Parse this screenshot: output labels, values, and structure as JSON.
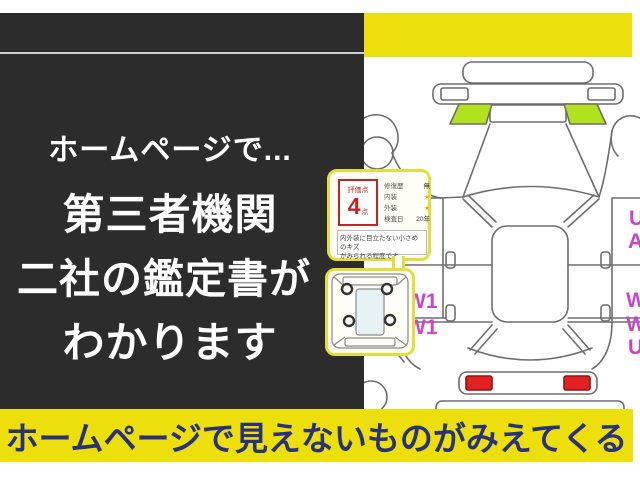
{
  "left_panel": {
    "lines": [
      "ホームページで...",
      "第三者機関",
      "二社の鑑定書が",
      "わかります"
    ]
  },
  "bottom_banner": {
    "text": "ホームページで見えないものがみえてくる"
  },
  "rating_card": {
    "score_label": "評価点",
    "score": "4",
    "score_unit": "点",
    "rows": [
      {
        "label": "修復歴",
        "value": "無"
      },
      {
        "label": "内装",
        "value": "★"
      },
      {
        "label": "外装",
        "value": "★"
      },
      {
        "label": "検査日",
        "value": "20年"
      }
    ],
    "note_line1": "内外装に目立たない小さめのキズ",
    "note_line2": "がみられる程度です。"
  },
  "diagram_marks": {
    "w1_left_top": "W1",
    "w1_left_bottom": "W1",
    "edge_u_top": "U",
    "edge_a": "A",
    "edge_w_top": "W",
    "edge_w_bottom": "W",
    "edge_u_bottom": "U"
  },
  "colors": {
    "frame_yellow": "#ecdf0c",
    "panel_dark": "#2d2c2c",
    "banner_text_navy": "#28317c",
    "highlight_lime": "#b2e21e",
    "damage_mark_magenta": "#c844c8",
    "taillight_red": "#e02222",
    "rating_red": "#c32525",
    "card_border_yellow": "#e4dd3c"
  }
}
